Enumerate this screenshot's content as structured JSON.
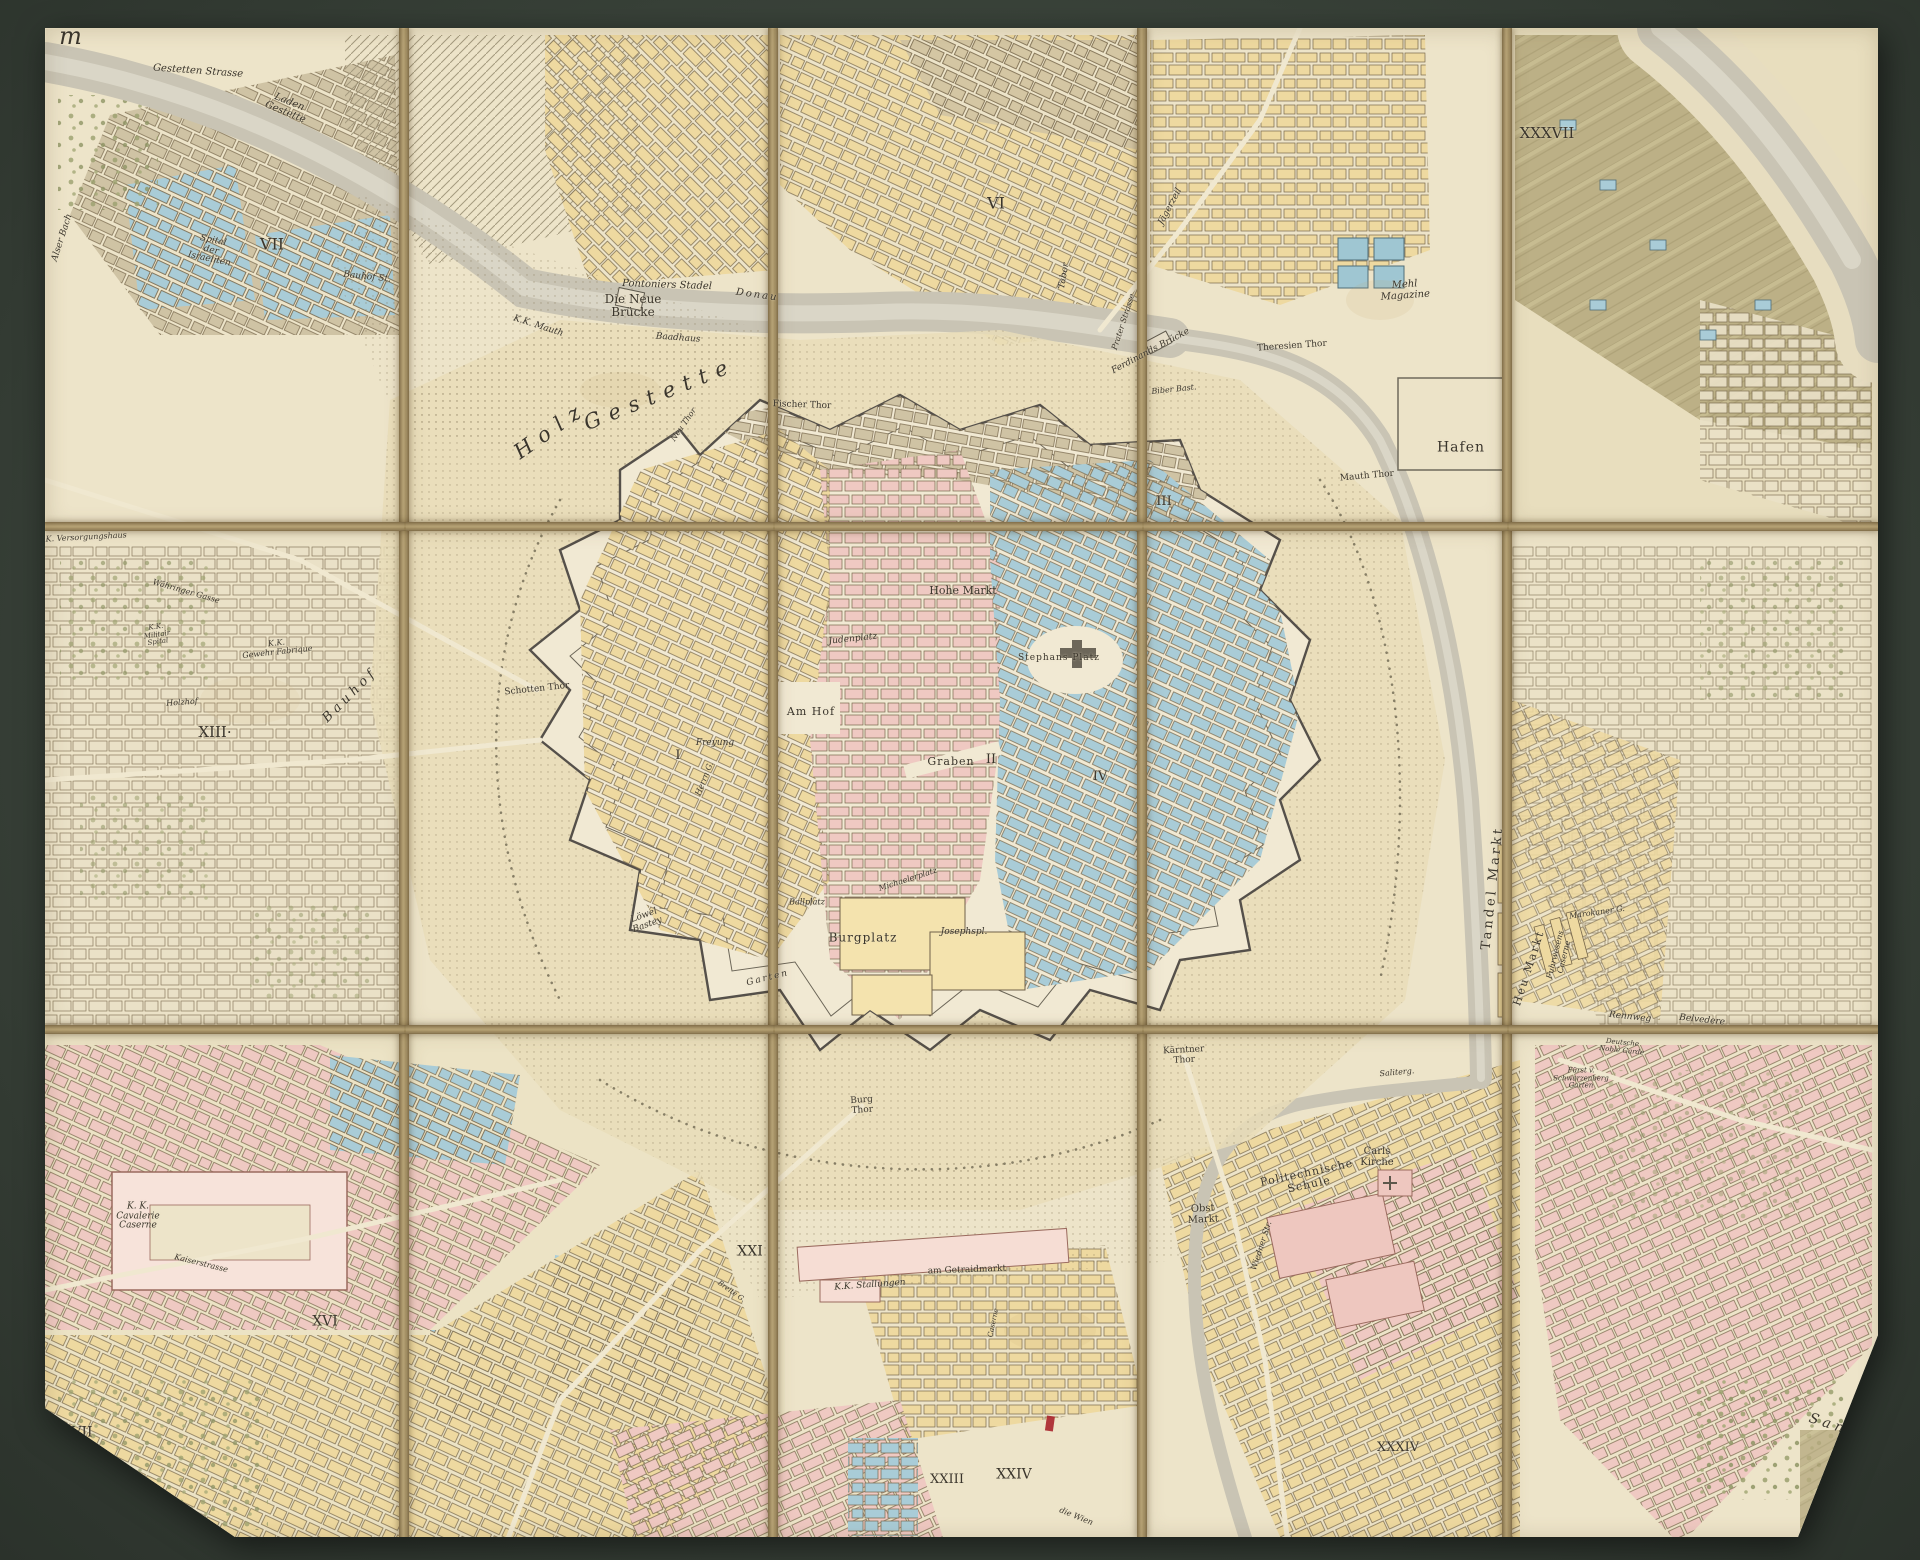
{
  "artifact": {
    "kind": "dissected hand-coloured city map, 15 panels mounted on dark linen board",
    "panel_grid": {
      "cols": 5,
      "rows": 3
    },
    "colors": {
      "mount_board": "#3a433a",
      "linen_fold": "#b7a376",
      "paper": "#ede4c9",
      "water": "#c9c4b4",
      "blocks_yellow": "#eed9a0",
      "blocks_pink": "#efc9c2",
      "blocks_blue": "#a9ccd7",
      "blocks_tan": "#cfc3a4",
      "fields_olive": "#b7ab80",
      "engraving_ink": "#3a352c",
      "red_ink_mark": "#a8242c"
    },
    "marks": [
      {
        "type": "red-ink-stroke",
        "x": 1050,
        "y": 1423
      }
    ]
  },
  "map": {
    "labels": [
      {
        "text": "r m",
        "x": 57,
        "y": 37,
        "size": 24,
        "italic": true,
        "spacing": 8
      },
      {
        "text": "Gestetten Strasse",
        "x": 198,
        "y": 72,
        "size": 10,
        "italic": true,
        "rot": 4
      },
      {
        "text": "Laden\nGestette",
        "x": 287,
        "y": 108,
        "size": 10,
        "italic": true,
        "rot": 22
      },
      {
        "text": "Spital\nder\nIsraeliten",
        "x": 211,
        "y": 251,
        "size": 9,
        "italic": true,
        "rot": 12
      },
      {
        "text": "VII",
        "x": 272,
        "y": 244,
        "size": 16
      },
      {
        "text": "Alser Bach",
        "x": 63,
        "y": 238,
        "size": 9,
        "italic": true,
        "rot": -72
      },
      {
        "text": "Bauhof St.",
        "x": 367,
        "y": 278,
        "size": 9,
        "italic": true,
        "rot": 6
      },
      {
        "text": "K.K. Mauth",
        "x": 538,
        "y": 327,
        "size": 9,
        "italic": true,
        "rot": 18
      },
      {
        "text": "Pontoniers Stadel",
        "x": 667,
        "y": 286,
        "size": 10,
        "italic": true,
        "rot": 2
      },
      {
        "text": "Die Neue\nBrücke",
        "x": 633,
        "y": 306,
        "size": 12
      },
      {
        "text": "Donau",
        "x": 757,
        "y": 296,
        "size": 10,
        "italic": true,
        "rot": 8,
        "spacing": 2
      },
      {
        "text": "Baadhaus",
        "x": 678,
        "y": 339,
        "size": 9,
        "italic": true,
        "rot": 4
      },
      {
        "text": "Holz",
        "x": 551,
        "y": 430,
        "size": 21,
        "italic": true,
        "rot": -35,
        "spacing": 9
      },
      {
        "text": "Gestette",
        "x": 660,
        "y": 394,
        "size": 21,
        "italic": true,
        "rot": -22,
        "spacing": 9
      },
      {
        "text": "Fischer Thor",
        "x": 802,
        "y": 406,
        "size": 9,
        "rot": 2
      },
      {
        "text": "Neu Thor",
        "x": 684,
        "y": 425,
        "size": 8,
        "italic": true,
        "rot": -55
      },
      {
        "text": "VI",
        "x": 996,
        "y": 203,
        "size": 16
      },
      {
        "text": "Tabor",
        "x": 1065,
        "y": 276,
        "size": 9,
        "italic": true,
        "rot": -80
      },
      {
        "text": "Jägerzeil",
        "x": 1171,
        "y": 207,
        "size": 9,
        "italic": true,
        "rot": -62
      },
      {
        "text": "XXXVII",
        "x": 1547,
        "y": 133,
        "size": 15
      },
      {
        "text": "Mehl\nMagazine",
        "x": 1405,
        "y": 291,
        "size": 10,
        "italic": true,
        "rot": -4
      },
      {
        "text": "Theresien Thor",
        "x": 1292,
        "y": 347,
        "size": 9,
        "rot": -4
      },
      {
        "text": "Ferdinands Brücke",
        "x": 1151,
        "y": 352,
        "size": 9,
        "italic": true,
        "rot": -28
      },
      {
        "text": "Prater Strasse",
        "x": 1124,
        "y": 322,
        "size": 8,
        "italic": true,
        "rot": -72
      },
      {
        "text": "Biber Bast.",
        "x": 1174,
        "y": 390,
        "size": 8,
        "italic": true,
        "rot": -6
      },
      {
        "text": "Mauth Thor",
        "x": 1367,
        "y": 477,
        "size": 9,
        "rot": -5
      },
      {
        "text": "Hafen",
        "x": 1461,
        "y": 448,
        "size": 14,
        "spacing": 1
      },
      {
        "text": "III",
        "x": 1164,
        "y": 502,
        "size": 13
      },
      {
        "text": "Hohe Markt",
        "x": 963,
        "y": 591,
        "size": 11
      },
      {
        "text": "Judenplatz",
        "x": 853,
        "y": 640,
        "size": 9,
        "italic": true,
        "rot": -6
      },
      {
        "text": "Stephans Platz",
        "x": 1059,
        "y": 659,
        "size": 9,
        "spacing": 1
      },
      {
        "text": "Am Hof",
        "x": 811,
        "y": 712,
        "size": 11,
        "spacing": 1
      },
      {
        "text": "Graben",
        "x": 951,
        "y": 762,
        "size": 11,
        "spacing": 1
      },
      {
        "text": "II",
        "x": 991,
        "y": 760,
        "size": 13
      },
      {
        "text": "I",
        "x": 678,
        "y": 756,
        "size": 13
      },
      {
        "text": "Freyung",
        "x": 715,
        "y": 744,
        "size": 9,
        "italic": true
      },
      {
        "text": "Herrn G.",
        "x": 705,
        "y": 779,
        "size": 8,
        "italic": true,
        "rot": -68
      },
      {
        "text": "Schotten Thor",
        "x": 537,
        "y": 690,
        "size": 9,
        "rot": -6
      },
      {
        "text": "Löwel\nBastey",
        "x": 646,
        "y": 921,
        "size": 9,
        "italic": true,
        "rot": -20
      },
      {
        "text": "Michaelerplatz",
        "x": 908,
        "y": 880,
        "size": 8,
        "italic": true,
        "rot": -18
      },
      {
        "text": "Ballplatz",
        "x": 807,
        "y": 903,
        "size": 8,
        "italic": true
      },
      {
        "text": "Burgplatz",
        "x": 863,
        "y": 938,
        "size": 12,
        "spacing": 1
      },
      {
        "text": "Josephspl.",
        "x": 964,
        "y": 933,
        "size": 9,
        "italic": true
      },
      {
        "text": "Garten",
        "x": 768,
        "y": 979,
        "size": 9,
        "italic": true,
        "rot": -14,
        "spacing": 2
      },
      {
        "text": "IV",
        "x": 1100,
        "y": 777,
        "size": 13
      },
      {
        "text": "Tandel Markt",
        "x": 1493,
        "y": 888,
        "size": 13,
        "rot": -84,
        "spacing": 3
      },
      {
        "text": "Heu Markt",
        "x": 1529,
        "y": 968,
        "size": 11,
        "rot": -72,
        "spacing": 2
      },
      {
        "text": "Fuhrwesens\nCaserne",
        "x": 1560,
        "y": 956,
        "size": 8,
        "italic": true,
        "rot": -76
      },
      {
        "text": "Marokaner G.",
        "x": 1597,
        "y": 913,
        "size": 8,
        "italic": true,
        "rot": -8
      },
      {
        "text": "Rennweg",
        "x": 1630,
        "y": 1018,
        "size": 9,
        "italic": true,
        "rot": 6
      },
      {
        "text": "Belvedere",
        "x": 1702,
        "y": 1021,
        "size": 9,
        "italic": true,
        "rot": 6
      },
      {
        "text": "Deutsche\nNoble Garde",
        "x": 1622,
        "y": 1047,
        "size": 7,
        "italic": true,
        "rot": 6
      },
      {
        "text": "Fürst v.\nSchwarzenberg\nGarten",
        "x": 1581,
        "y": 1079,
        "size": 7,
        "italic": true
      },
      {
        "text": "Kärntner\nThor",
        "x": 1184,
        "y": 1056,
        "size": 9,
        "rot": -3
      },
      {
        "text": "Obst\nMarkt",
        "x": 1203,
        "y": 1215,
        "size": 10,
        "rot": -3
      },
      {
        "text": "Politechnische\nSchule",
        "x": 1308,
        "y": 1179,
        "size": 11,
        "rot": -12,
        "spacing": 1
      },
      {
        "text": "Carls\nKirche",
        "x": 1377,
        "y": 1158,
        "size": 10
      },
      {
        "text": "Saliterg.",
        "x": 1397,
        "y": 1073,
        "size": 8,
        "italic": true,
        "rot": -5
      },
      {
        "text": "Wiedner Str.",
        "x": 1262,
        "y": 1246,
        "size": 8,
        "italic": true,
        "rot": -72
      },
      {
        "text": "Burg\nThor",
        "x": 862,
        "y": 1106,
        "size": 9,
        "rot": -4
      },
      {
        "text": "K.K. Versorgungshaus",
        "x": 82,
        "y": 538,
        "size": 8,
        "italic": true,
        "rot": -3
      },
      {
        "text": "Währinger Gasse",
        "x": 186,
        "y": 592,
        "size": 8,
        "italic": true,
        "rot": 16
      },
      {
        "text": "K.K.\nMilitair\nSpital",
        "x": 157,
        "y": 635,
        "size": 7,
        "italic": true,
        "rot": -8
      },
      {
        "text": "K.K.\nGewehr Fabrique",
        "x": 277,
        "y": 648,
        "size": 8,
        "italic": true,
        "rot": -6
      },
      {
        "text": "Holzhof",
        "x": 182,
        "y": 703,
        "size": 8,
        "italic": true,
        "rot": -4
      },
      {
        "text": "XIII·",
        "x": 215,
        "y": 732,
        "size": 15
      },
      {
        "text": "B a u h o f",
        "x": 349,
        "y": 697,
        "size": 13,
        "italic": true,
        "rot": -45
      },
      {
        "text": "K. K.\nCavalerie\nCaserne",
        "x": 138,
        "y": 1217,
        "size": 9,
        "italic": true
      },
      {
        "text": "Kaiserstrasse",
        "x": 201,
        "y": 1264,
        "size": 8,
        "italic": true,
        "rot": 14
      },
      {
        "text": "XVI",
        "x": 325,
        "y": 1322,
        "size": 14
      },
      {
        "text": "XVII",
        "x": 77,
        "y": 1433,
        "size": 14
      },
      {
        "text": "XXI",
        "x": 750,
        "y": 1252,
        "size": 14
      },
      {
        "text": "K.K. Stallungen",
        "x": 870,
        "y": 1286,
        "size": 9,
        "italic": true,
        "rot": -4
      },
      {
        "text": "am Getraidmarkt",
        "x": 967,
        "y": 1271,
        "size": 9,
        "rot": -2
      },
      {
        "text": "Breite G.",
        "x": 731,
        "y": 1292,
        "size": 7,
        "italic": true,
        "rot": 35
      },
      {
        "text": "Caserne",
        "x": 994,
        "y": 1323,
        "size": 7,
        "italic": true,
        "rot": -78
      },
      {
        "text": "XXIII",
        "x": 947,
        "y": 1480,
        "size": 13
      },
      {
        "text": "XXIV",
        "x": 1014,
        "y": 1475,
        "size": 14
      },
      {
        "text": "die Wien",
        "x": 1076,
        "y": 1517,
        "size": 8,
        "italic": true,
        "rot": 22
      },
      {
        "text": "XXXIV",
        "x": 1398,
        "y": 1448,
        "size": 13
      },
      {
        "text": "S a n d g",
        "x": 1839,
        "y": 1428,
        "size": 14,
        "italic": true,
        "rot": 18
      }
    ]
  }
}
